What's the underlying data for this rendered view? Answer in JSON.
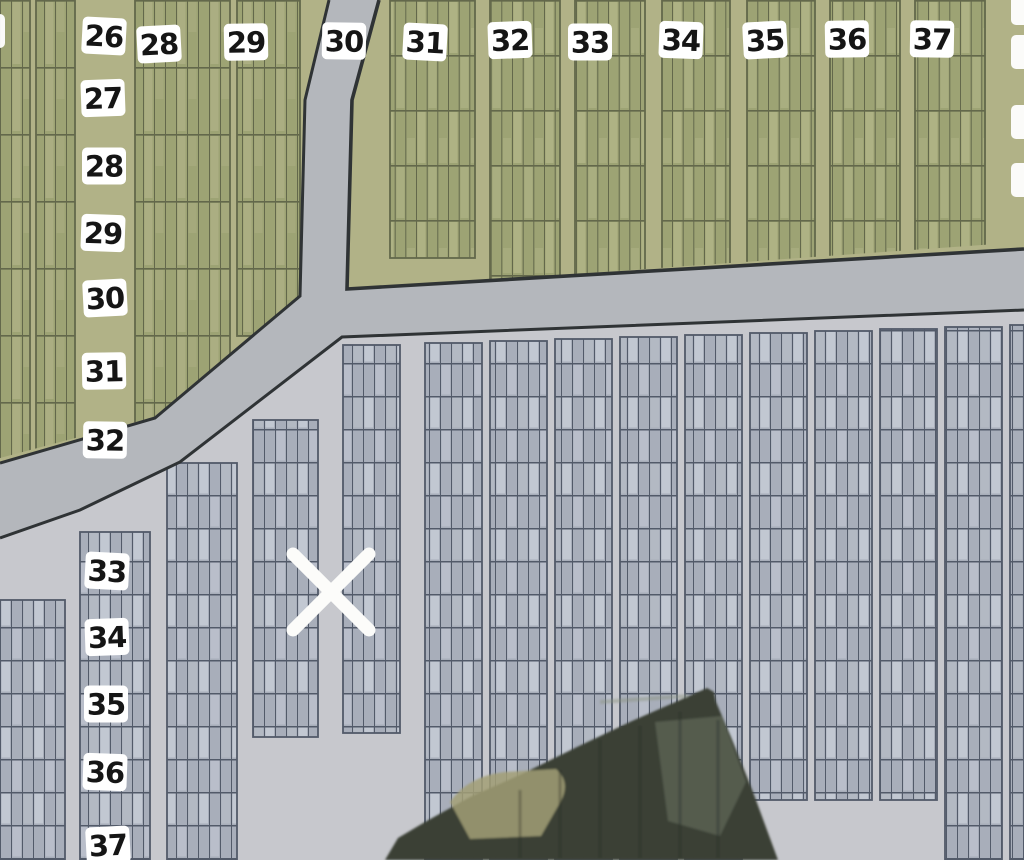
{
  "map": {
    "type": "cemetery-plot-section-map",
    "marker": {
      "symbol": "X",
      "x": 331,
      "y": 592,
      "arm": 38,
      "stroke_width": 13
    },
    "top_row_labels": [
      {
        "text": "28",
        "x": 159,
        "y": 44
      },
      {
        "text": "29",
        "x": 246,
        "y": 42
      },
      {
        "text": "30",
        "x": 344,
        "y": 41
      },
      {
        "text": "31",
        "x": 425,
        "y": 42
      },
      {
        "text": "32",
        "x": 510,
        "y": 40
      },
      {
        "text": "33",
        "x": 590,
        "y": 42
      },
      {
        "text": "34",
        "x": 681,
        "y": 40
      },
      {
        "text": "35",
        "x": 765,
        "y": 40
      },
      {
        "text": "36",
        "x": 847,
        "y": 39
      },
      {
        "text": "37",
        "x": 932,
        "y": 39
      }
    ],
    "left_col_labels": [
      {
        "text": "26",
        "x": 104,
        "y": 36
      },
      {
        "text": "27",
        "x": 103,
        "y": 98
      },
      {
        "text": "28",
        "x": 104,
        "y": 166
      },
      {
        "text": "29",
        "x": 103,
        "y": 233
      },
      {
        "text": "30",
        "x": 105,
        "y": 298
      },
      {
        "text": "31",
        "x": 104,
        "y": 371
      },
      {
        "text": "32",
        "x": 105,
        "y": 440
      },
      {
        "text": "33",
        "x": 107,
        "y": 571
      },
      {
        "text": "34",
        "x": 107,
        "y": 637
      },
      {
        "text": "35",
        "x": 106,
        "y": 704
      },
      {
        "text": "36",
        "x": 105,
        "y": 772
      },
      {
        "text": "37",
        "x": 108,
        "y": 845
      }
    ],
    "left_edge_partial_labels": [
      {
        "x": -8,
        "y": 31
      }
    ],
    "right_edge_partial_labels": [
      {
        "x": 1024,
        "y": 8
      },
      {
        "x": 1024,
        "y": 52
      },
      {
        "x": 1024,
        "y": 122
      },
      {
        "x": 1024,
        "y": 180
      }
    ],
    "colors": {
      "green_section": "#b1b287",
      "green_plot": "#9da374",
      "green_plot_light": "#bcbd92",
      "green_line": "#63684b",
      "gray_section": "#c7c8cd",
      "gray_plot": "#a8aeba",
      "gray_plot_light": "#e2e7ef",
      "gray_line": "#525a69",
      "road": "#b4b7bc",
      "road_edge": "#2f3335",
      "label_bg": "#ffffff",
      "label_text": "#151515",
      "marker": "#fcfcfa",
      "tree": "#3b4135",
      "tree_patch_khaki": "#a29f76",
      "tree_patch_gray": "#6e7668"
    }
  }
}
